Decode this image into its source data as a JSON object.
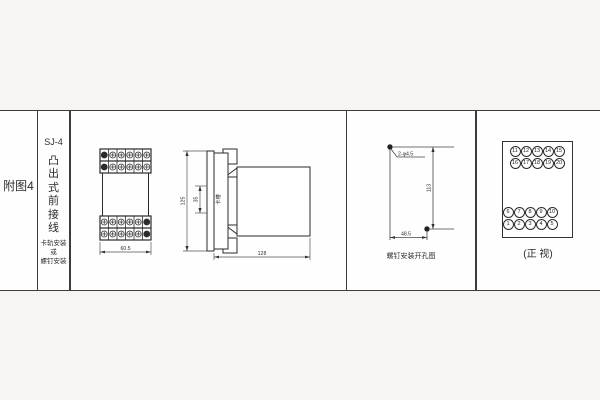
{
  "meta": {
    "background_color": "#f6f5f3",
    "panel_color": "#fefefe",
    "line_color": "#333333"
  },
  "index_column": {
    "label": "附图4"
  },
  "title_column": {
    "model": "SJ-4",
    "type_text": "凸出式前接线",
    "mount_line1": "卡轨安装",
    "mount_line2": "或",
    "mount_line3": "螺钉安装"
  },
  "front_view": {
    "width_dim": "60.5"
  },
  "side_view": {
    "height_dim": "125",
    "slot_dim": "35",
    "slot_label": "卡槽",
    "depth_dim": "128"
  },
  "drill_view": {
    "hole_label": "2-φ4.5",
    "vertical_dim": "113",
    "horizontal_dim": "48.5",
    "caption": "螺钉安装开孔图"
  },
  "terminal_view": {
    "caption": "(正 视)",
    "top_rows": [
      [
        "11",
        "12",
        "13",
        "14",
        "15"
      ],
      [
        "16",
        "17",
        "18",
        "19",
        "20"
      ]
    ],
    "bottom_rows": [
      [
        "6",
        "7",
        "8",
        "9",
        "10"
      ],
      [
        "1",
        "2",
        "3",
        "4",
        "5"
      ]
    ]
  }
}
